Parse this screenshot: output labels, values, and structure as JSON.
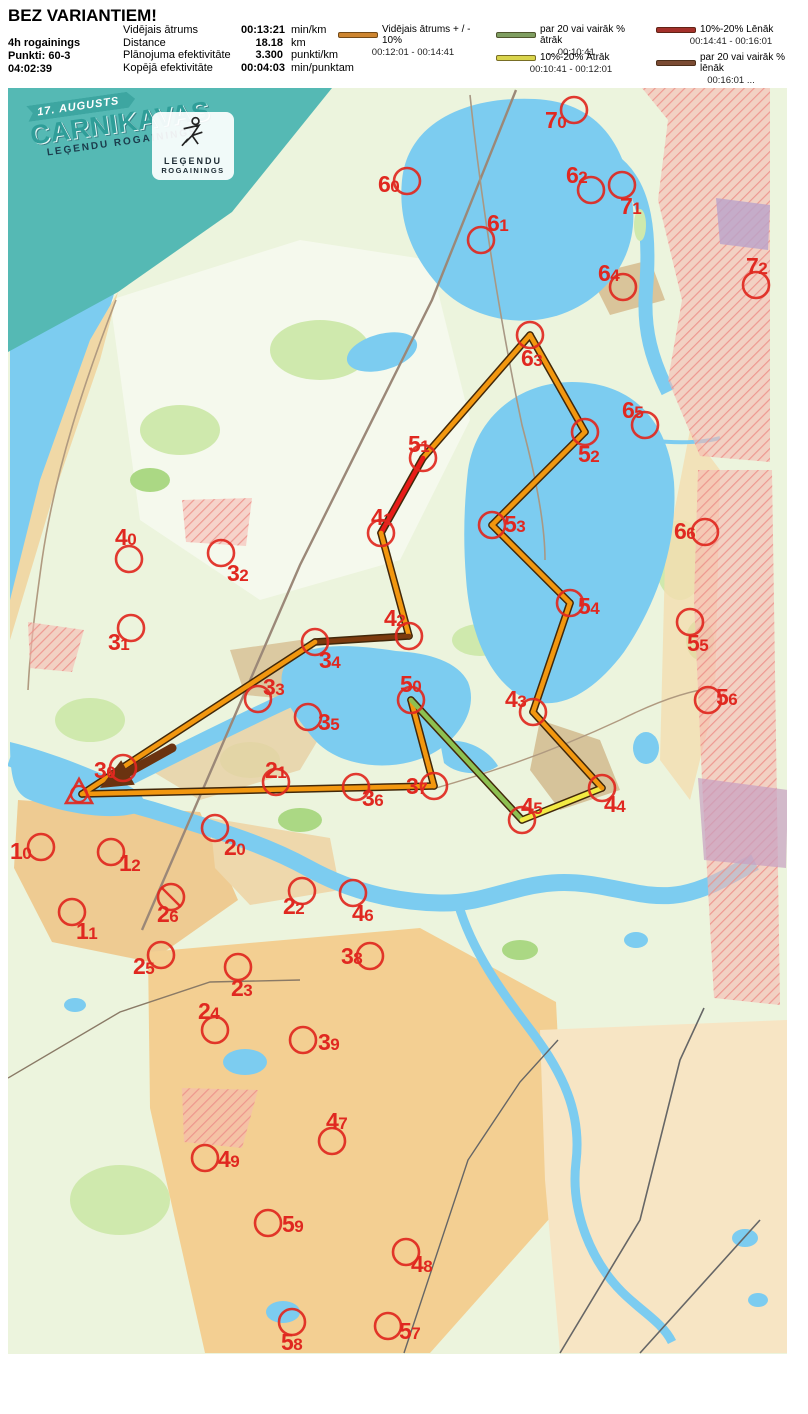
{
  "header": {
    "title": "BEZ VARIANTIEM!",
    "event": "4h rogainings",
    "points": "Punkti: 60-3",
    "time": "04:02:39",
    "stats": [
      {
        "label": "Vidējais ātrums",
        "value": "00:13:21",
        "unit": "min/km"
      },
      {
        "label": "Distance",
        "value": "18.18",
        "unit": "km"
      },
      {
        "label": "Plānojuma efektivitāte",
        "value": "3.300",
        "unit": "punkti/km"
      },
      {
        "label": "Kopējā efektivitāte",
        "value": "00:04:03",
        "unit": "min/punktam"
      }
    ],
    "legend": [
      {
        "label": "Vidējais ātrums + / - 10%",
        "range": "00:12:01   -   00:14:41",
        "color": "#cd8530"
      },
      {
        "label": "par 20 vai vairāk % ātrāk",
        "range": "...   00:10:41",
        "color": "#7f9e61"
      },
      {
        "label": "10%-20% Ātrāk",
        "range": "00:10:41   -   00:12:01",
        "color": "#d9d44c"
      },
      {
        "label": "10%-20% Lēnāk",
        "range": "00:14:41   - 00:16:01",
        "color": "#a4302a"
      },
      {
        "label": "par 20 vai vairāk % lēnāk",
        "range": "00:16:01   ...",
        "color": "#7b4b33"
      }
    ]
  },
  "banner": {
    "date": "17. AUGUSTS",
    "title": "CARNIKAVAS",
    "subtitle": "LEĢENDU ROGAININGS"
  },
  "logo": {
    "line1": "LEĢENDU",
    "line2": "ROGAININGS"
  },
  "map": {
    "control_color": "#e02820",
    "route_colors": {
      "avg": "#f2970f",
      "fast20": "#8dc051",
      "fast10": "#f2ea43",
      "slow10": "#e81c18",
      "slow20": "#7c3a0e",
      "outline": "#42280a"
    },
    "start": {
      "x": 79,
      "y": 794
    },
    "finish_arrow": {
      "tip": [
        100,
        788
      ],
      "tail": [
        172,
        748
      ]
    },
    "route": [
      {
        "x1": 82,
        "y1": 794,
        "x2": 434,
        "y2": 786,
        "c": "avg"
      },
      {
        "x1": 434,
        "y1": 786,
        "x2": 411,
        "y2": 700,
        "c": "avg"
      },
      {
        "x1": 411,
        "y1": 700,
        "x2": 522,
        "y2": 820,
        "c": "fast20"
      },
      {
        "x1": 522,
        "y1": 820,
        "x2": 602,
        "y2": 788,
        "c": "fast10"
      },
      {
        "x1": 602,
        "y1": 788,
        "x2": 533,
        "y2": 712,
        "c": "avg"
      },
      {
        "x1": 533,
        "y1": 712,
        "x2": 570,
        "y2": 603,
        "c": "avg"
      },
      {
        "x1": 570,
        "y1": 603,
        "x2": 492,
        "y2": 525,
        "c": "avg"
      },
      {
        "x1": 492,
        "y1": 525,
        "x2": 585,
        "y2": 432,
        "c": "avg"
      },
      {
        "x1": 585,
        "y1": 432,
        "x2": 530,
        "y2": 335,
        "c": "avg"
      },
      {
        "x1": 530,
        "y1": 335,
        "x2": 423,
        "y2": 458,
        "c": "avg"
      },
      {
        "x1": 423,
        "y1": 458,
        "x2": 381,
        "y2": 533,
        "c": "slow10"
      },
      {
        "x1": 381,
        "y1": 533,
        "x2": 409,
        "y2": 636,
        "c": "avg"
      },
      {
        "x1": 409,
        "y1": 636,
        "x2": 315,
        "y2": 642,
        "c": "slow20"
      },
      {
        "x1": 315,
        "y1": 642,
        "x2": 82,
        "y2": 794,
        "c": "avg"
      }
    ],
    "controls": [
      {
        "id": "70",
        "cx": 574,
        "cy": 110,
        "lx": 545,
        "ly": 128
      },
      {
        "id": "60",
        "cx": 407,
        "cy": 181,
        "lx": 378,
        "ly": 192
      },
      {
        "id": "62",
        "cx": 591,
        "cy": 190,
        "lx": 566,
        "ly": 183
      },
      {
        "id": "71",
        "cx": 622,
        "cy": 185,
        "lx": 620,
        "ly": 214
      },
      {
        "id": "61",
        "cx": 481,
        "cy": 240,
        "lx": 487,
        "ly": 231
      },
      {
        "id": "64",
        "cx": 623,
        "cy": 287,
        "lx": 598,
        "ly": 281
      },
      {
        "id": "72",
        "cx": 756,
        "cy": 285,
        "lx": 746,
        "ly": 274
      },
      {
        "id": "63",
        "cx": 530,
        "cy": 335,
        "lx": 521,
        "ly": 366
      },
      {
        "id": "65",
        "cx": 645,
        "cy": 425,
        "lx": 622,
        "ly": 418
      },
      {
        "id": "51",
        "cx": 423,
        "cy": 458,
        "lx": 408,
        "ly": 452
      },
      {
        "id": "52",
        "cx": 585,
        "cy": 432,
        "lx": 578,
        "ly": 462
      },
      {
        "id": "41",
        "cx": 381,
        "cy": 533,
        "lx": 371,
        "ly": 525
      },
      {
        "id": "53",
        "cx": 492,
        "cy": 525,
        "lx": 504,
        "ly": 532
      },
      {
        "id": "66",
        "cx": 705,
        "cy": 532,
        "lx": 674,
        "ly": 539
      },
      {
        "id": "40",
        "cx": 129,
        "cy": 559,
        "lx": 115,
        "ly": 545
      },
      {
        "id": "32",
        "cx": 221,
        "cy": 553,
        "lx": 227,
        "ly": 581
      },
      {
        "id": "54",
        "cx": 570,
        "cy": 603,
        "lx": 578,
        "ly": 614
      },
      {
        "id": "55",
        "cx": 690,
        "cy": 622,
        "lx": 687,
        "ly": 651
      },
      {
        "id": "31",
        "cx": 131,
        "cy": 628,
        "lx": 108,
        "ly": 650
      },
      {
        "id": "42",
        "cx": 409,
        "cy": 636,
        "lx": 384,
        "ly": 626
      },
      {
        "id": "34",
        "cx": 315,
        "cy": 642,
        "lx": 319,
        "ly": 668
      },
      {
        "id": "33",
        "cx": 258,
        "cy": 699,
        "lx": 263,
        "ly": 695
      },
      {
        "id": "56",
        "cx": 708,
        "cy": 700,
        "lx": 716,
        "ly": 705
      },
      {
        "id": "35",
        "cx": 308,
        "cy": 717,
        "lx": 318,
        "ly": 730
      },
      {
        "id": "50",
        "cx": 411,
        "cy": 700,
        "lx": 400,
        "ly": 692
      },
      {
        "id": "43",
        "cx": 533,
        "cy": 712,
        "lx": 505,
        "ly": 707
      },
      {
        "id": "21",
        "cx": 276,
        "cy": 782,
        "lx": 265,
        "ly": 778
      },
      {
        "id": "30",
        "cx": 123,
        "cy": 768,
        "lx": 94,
        "ly": 778
      },
      {
        "id": "36",
        "cx": 356,
        "cy": 787,
        "lx": 362,
        "ly": 806
      },
      {
        "id": "37",
        "cx": 434,
        "cy": 786,
        "lx": 406,
        "ly": 794
      },
      {
        "id": "45",
        "cx": 522,
        "cy": 820,
        "lx": 521,
        "ly": 814
      },
      {
        "id": "44",
        "cx": 602,
        "cy": 788,
        "lx": 604,
        "ly": 812
      },
      {
        "id": "10",
        "cx": 41,
        "cy": 847,
        "lx": 10,
        "ly": 859
      },
      {
        "id": "20",
        "cx": 215,
        "cy": 828,
        "lx": 224,
        "ly": 855
      },
      {
        "id": "12",
        "cx": 111,
        "cy": 852,
        "lx": 119,
        "ly": 871
      },
      {
        "id": "22",
        "cx": 302,
        "cy": 891,
        "lx": 283,
        "ly": 914
      },
      {
        "id": "26",
        "cx": 171,
        "cy": 897,
        "lx": 157,
        "ly": 922,
        "crossed": true
      },
      {
        "id": "11",
        "cx": 72,
        "cy": 912,
        "lx": 76,
        "ly": 939
      },
      {
        "id": "46",
        "cx": 353,
        "cy": 893,
        "lx": 352,
        "ly": 921
      },
      {
        "id": "25",
        "cx": 161,
        "cy": 955,
        "lx": 133,
        "ly": 974
      },
      {
        "id": "38",
        "cx": 370,
        "cy": 956,
        "lx": 341,
        "ly": 964
      },
      {
        "id": "23",
        "cx": 238,
        "cy": 967,
        "lx": 231,
        "ly": 996
      },
      {
        "id": "24",
        "cx": 215,
        "cy": 1030,
        "lx": 198,
        "ly": 1019
      },
      {
        "id": "39",
        "cx": 303,
        "cy": 1040,
        "lx": 318,
        "ly": 1050
      },
      {
        "id": "47",
        "cx": 332,
        "cy": 1141,
        "lx": 326,
        "ly": 1129
      },
      {
        "id": "49",
        "cx": 205,
        "cy": 1158,
        "lx": 218,
        "ly": 1167
      },
      {
        "id": "59",
        "cx": 268,
        "cy": 1223,
        "lx": 282,
        "ly": 1232
      },
      {
        "id": "48",
        "cx": 406,
        "cy": 1252,
        "lx": 411,
        "ly": 1272
      },
      {
        "id": "58",
        "cx": 292,
        "cy": 1322,
        "lx": 281,
        "ly": 1350
      },
      {
        "id": "57",
        "cx": 388,
        "cy": 1326,
        "lx": 399,
        "ly": 1339
      }
    ]
  }
}
